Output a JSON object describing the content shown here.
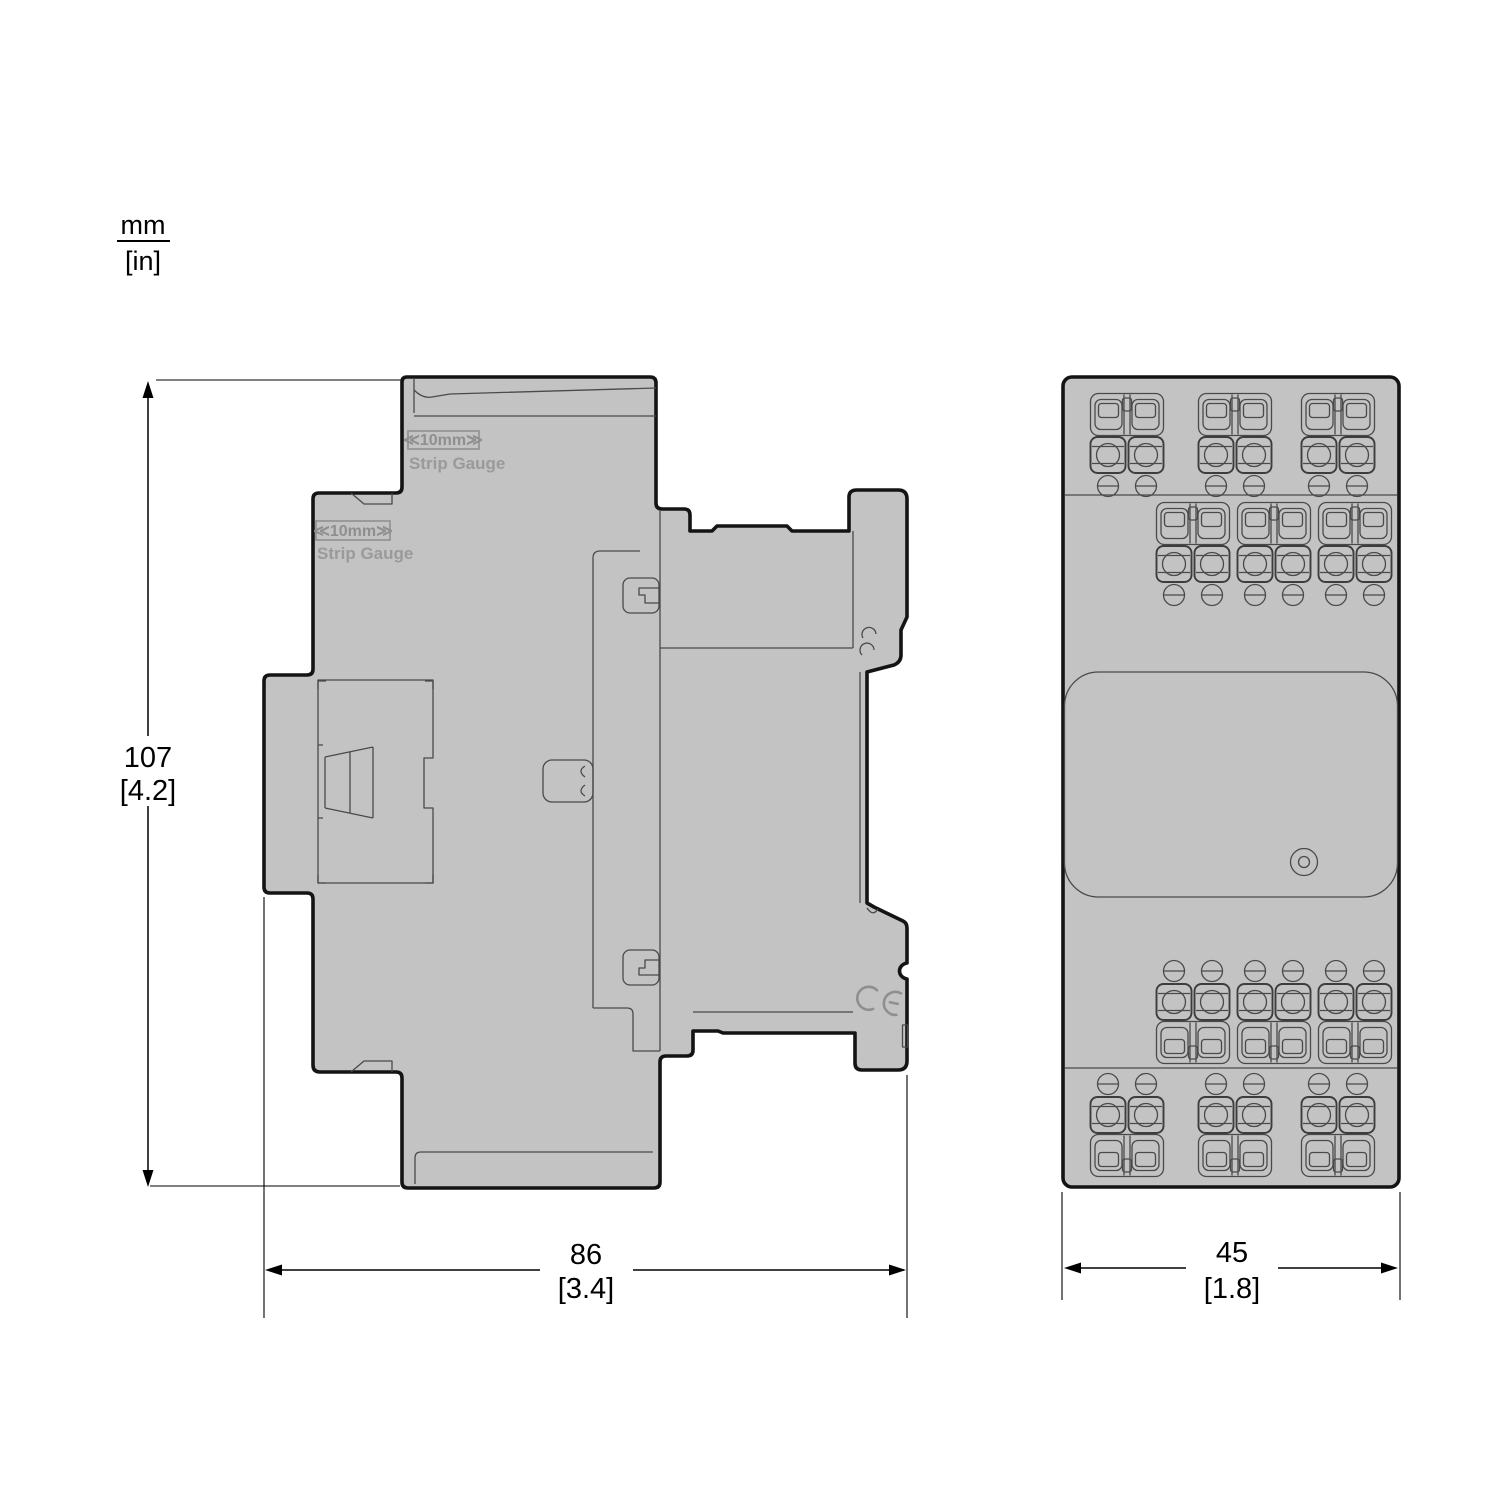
{
  "unit_legend": {
    "primary": "mm",
    "secondary": "[in]"
  },
  "dimensions": {
    "height": {
      "value": "107",
      "inches": "[4.2]"
    },
    "depth": {
      "value": "86",
      "inches": "[3.4]"
    },
    "width": {
      "value": "45",
      "inches": "[1.8]"
    }
  },
  "side_view": {
    "strip_gauge_upper": {
      "badge": "≪10mm≫",
      "label": "Strip Gauge"
    },
    "strip_gauge_lower": {
      "badge": "≪10mm≫",
      "label": "Strip Gauge"
    },
    "ce_mark": "CE"
  },
  "colors": {
    "background": "#ffffff",
    "body_fill": "#c3c3c3",
    "outline": "#141414",
    "detail_line": "#4a4a4a",
    "engraved": "#8f8f8f",
    "dimension": "#000000"
  }
}
